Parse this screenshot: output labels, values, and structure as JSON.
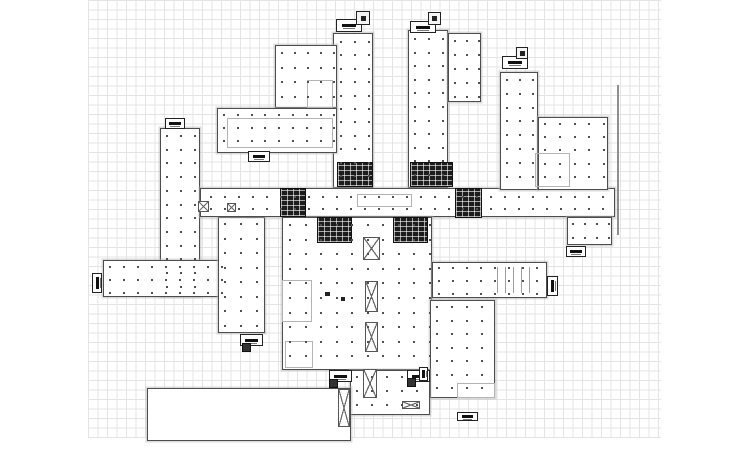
{
  "drawing": {
    "type": "architectural-floor-plan",
    "canvas": {
      "width": 750,
      "height": 450,
      "background": "#ffffff"
    },
    "grid": {
      "x": 88,
      "y": 0,
      "w": 573,
      "h": 438,
      "cell": 9.5,
      "line_color": "#e4e4e4"
    },
    "ref_line": {
      "x": 617,
      "y": 85,
      "h": 150,
      "thickness": 2,
      "color": "#8f8f8f"
    },
    "colors": {
      "outline": "#4d4d4d",
      "inner": "#b3b3b3",
      "core": "#1d1d1d",
      "dot": "#4f4f4f"
    },
    "masses": [
      {
        "name": "wing-north-a",
        "x": 333,
        "y": 33,
        "w": 40,
        "h": 155
      },
      {
        "name": "wing-north-b",
        "x": 408,
        "y": 30,
        "w": 40,
        "h": 158
      },
      {
        "name": "wing-north-b-annex",
        "x": 448,
        "y": 33,
        "w": 33,
        "h": 69
      },
      {
        "name": "block-northwest-upper",
        "x": 275,
        "y": 45,
        "w": 62,
        "h": 63
      },
      {
        "name": "block-northwest-lower",
        "x": 217,
        "y": 108,
        "w": 120,
        "h": 45
      },
      {
        "name": "wing-west-vertical",
        "x": 160,
        "y": 128,
        "w": 40,
        "h": 169
      },
      {
        "name": "wing-west-horizontal",
        "x": 103,
        "y": 260,
        "w": 124,
        "h": 37
      },
      {
        "name": "wing-center-west",
        "x": 218,
        "y": 217,
        "w": 47,
        "h": 116
      },
      {
        "name": "central-corridor",
        "x": 200,
        "y": 188,
        "w": 415,
        "h": 29
      },
      {
        "name": "central-block",
        "x": 282,
        "y": 217,
        "w": 150,
        "h": 153
      },
      {
        "name": "wing-east-horizontal",
        "x": 432,
        "y": 262,
        "w": 115,
        "h": 36
      },
      {
        "name": "wing-northeast-vertical",
        "x": 500,
        "y": 72,
        "w": 38,
        "h": 118
      },
      {
        "name": "wing-northeast-annex",
        "x": 538,
        "y": 117,
        "w": 70,
        "h": 73
      },
      {
        "name": "block-east-mid",
        "x": 567,
        "y": 217,
        "w": 45,
        "h": 28
      },
      {
        "name": "block-southeast",
        "x": 430,
        "y": 300,
        "w": 65,
        "h": 98
      },
      {
        "name": "wing-south-center",
        "x": 350,
        "y": 370,
        "w": 80,
        "h": 45
      },
      {
        "name": "hall-south-west",
        "x": 147,
        "y": 388,
        "w": 204,
        "h": 53
      }
    ],
    "inner_rects": [
      {
        "name": "room-northwest-inner",
        "x": 227,
        "y": 118,
        "w": 106,
        "h": 30
      },
      {
        "name": "room-northwest-corner",
        "x": 307,
        "y": 80,
        "w": 26,
        "h": 28
      },
      {
        "name": "corridor-center-strip",
        "x": 357,
        "y": 194,
        "w": 55,
        "h": 13
      },
      {
        "name": "room-central-west",
        "x": 282,
        "y": 280,
        "w": 30,
        "h": 42
      },
      {
        "name": "room-central-south",
        "x": 285,
        "y": 341,
        "w": 28,
        "h": 27
      },
      {
        "name": "room-northeast-square",
        "x": 535,
        "y": 153,
        "w": 35,
        "h": 34
      },
      {
        "name": "room-southeast-step",
        "x": 457,
        "y": 383,
        "w": 38,
        "h": 15
      }
    ],
    "cores": [
      {
        "name": "core-wing-a",
        "x": 337,
        "y": 162,
        "w": 36,
        "h": 25
      },
      {
        "name": "core-wing-b",
        "x": 410,
        "y": 162,
        "w": 43,
        "h": 25
      },
      {
        "name": "core-corridor-west",
        "x": 280,
        "y": 188,
        "w": 26,
        "h": 29
      },
      {
        "name": "core-corridor-east",
        "x": 455,
        "y": 188,
        "w": 27,
        "h": 30
      },
      {
        "name": "core-central-left",
        "x": 317,
        "y": 217,
        "w": 35,
        "h": 26
      },
      {
        "name": "core-central-right",
        "x": 393,
        "y": 217,
        "w": 35,
        "h": 26
      }
    ],
    "crossed_boxes": [
      {
        "name": "shaft-1",
        "x": 363,
        "y": 237,
        "w": 17,
        "h": 23
      },
      {
        "name": "shaft-2",
        "x": 365,
        "y": 281,
        "w": 13,
        "h": 31
      },
      {
        "name": "shaft-3",
        "x": 365,
        "y": 322,
        "w": 13,
        "h": 30
      },
      {
        "name": "shaft-4",
        "x": 363,
        "y": 369,
        "w": 14,
        "h": 29
      },
      {
        "name": "shaft-5",
        "x": 338,
        "y": 389,
        "w": 12,
        "h": 38
      },
      {
        "name": "shaft-west-1",
        "x": 198,
        "y": 201,
        "w": 11,
        "h": 11
      },
      {
        "name": "shaft-west-2",
        "x": 227,
        "y": 203,
        "w": 9,
        "h": 9
      },
      {
        "name": "vent-bowtie",
        "x": 402,
        "y": 401,
        "w": 18,
        "h": 8
      }
    ],
    "tags": [
      {
        "name": "stair-tag-wing-a",
        "x": 336,
        "y": 19,
        "w": 26,
        "h": 13,
        "dir": "h"
      },
      {
        "name": "stair-tag-wing-b",
        "x": 410,
        "y": 21,
        "w": 26,
        "h": 12,
        "dir": "h"
      },
      {
        "name": "stair-tag-northeast",
        "x": 502,
        "y": 56,
        "w": 26,
        "h": 13,
        "dir": "h"
      },
      {
        "name": "stair-tag-northwest",
        "x": 248,
        "y": 151,
        "w": 22,
        "h": 11,
        "dir": "h"
      },
      {
        "name": "stair-tag-west-top",
        "x": 165,
        "y": 118,
        "w": 20,
        "h": 11,
        "dir": "h"
      },
      {
        "name": "stair-tag-center-south",
        "x": 240,
        "y": 334,
        "w": 23,
        "h": 12,
        "dir": "h"
      },
      {
        "name": "stair-tag-south-left",
        "x": 329,
        "y": 370,
        "w": 23,
        "h": 12,
        "dir": "h"
      },
      {
        "name": "stair-tag-south-right",
        "x": 407,
        "y": 370,
        "w": 23,
        "h": 12,
        "dir": "h"
      },
      {
        "name": "stair-tag-east-mid",
        "x": 566,
        "y": 246,
        "w": 20,
        "h": 11,
        "dir": "h"
      },
      {
        "name": "stair-tag-southeast",
        "x": 457,
        "y": 412,
        "w": 21,
        "h": 9,
        "dir": "h"
      },
      {
        "name": "stair-tag-west-end",
        "x": 92,
        "y": 273,
        "w": 10,
        "h": 20,
        "dir": "v"
      },
      {
        "name": "stair-tag-east-end",
        "x": 547,
        "y": 276,
        "w": 11,
        "h": 20,
        "dir": "v"
      },
      {
        "name": "stair-tag-south-edge",
        "x": 419,
        "y": 367,
        "w": 9,
        "h": 14,
        "dir": "v"
      }
    ],
    "tag_topboxes": [
      {
        "name": "roof-box-wing-a",
        "x": 356,
        "y": 11,
        "w": 14,
        "h": 14
      },
      {
        "name": "roof-box-wing-b",
        "x": 428,
        "y": 12,
        "w": 13,
        "h": 13
      },
      {
        "name": "roof-box-northeast",
        "x": 516,
        "y": 47,
        "w": 12,
        "h": 12
      }
    ],
    "tag_squares": [
      {
        "name": "exit-square-center-south",
        "x": 242,
        "y": 343,
        "w": 9,
        "h": 9
      },
      {
        "name": "exit-square-south-left",
        "x": 329,
        "y": 379,
        "w": 9,
        "h": 9
      },
      {
        "name": "exit-square-south-right",
        "x": 407,
        "y": 378,
        "w": 9,
        "h": 9
      }
    ],
    "stall_lines": {
      "x0": 497,
      "y": 267,
      "h": 26,
      "count": 5,
      "dx": 8,
      "thickness": 1
    },
    "micro_marks": [
      {
        "x": 325,
        "y": 292,
        "w": 5,
        "h": 4
      },
      {
        "x": 341,
        "y": 297,
        "w": 4,
        "h": 4
      }
    ],
    "column_grids": [
      {
        "name": "cols-wing-a",
        "x": 340,
        "y": 41,
        "nx": 3,
        "ny": 11,
        "dx": 14,
        "dy": 13.4
      },
      {
        "name": "cols-wing-b",
        "x": 414,
        "y": 38,
        "nx": 3,
        "ny": 11,
        "dx": 14,
        "dy": 13.6
      },
      {
        "name": "cols-wing-b-annex",
        "x": 454,
        "y": 40,
        "nx": 3,
        "ny": 5,
        "dx": 12,
        "dy": 14
      },
      {
        "name": "cols-northwest-upper",
        "x": 281,
        "y": 52,
        "nx": 5,
        "ny": 4,
        "dx": 13,
        "dy": 14.5
      },
      {
        "name": "cols-northwest-lower",
        "x": 223,
        "y": 114,
        "nx": 9,
        "ny": 3,
        "dx": 13.8,
        "dy": 13
      },
      {
        "name": "cols-west-vertical",
        "x": 166,
        "y": 135,
        "nx": 3,
        "ny": 12,
        "dx": 14,
        "dy": 13.7
      },
      {
        "name": "cols-west-horizontal",
        "x": 109,
        "y": 266,
        "nx": 9,
        "ny": 3,
        "dx": 14,
        "dy": 13
      },
      {
        "name": "cols-center-west",
        "x": 224,
        "y": 223,
        "nx": 3,
        "ny": 8,
        "dx": 16,
        "dy": 14.5
      },
      {
        "name": "cols-corridor",
        "x": 210,
        "y": 196,
        "nx": 29,
        "ny": 2,
        "dx": 14,
        "dy": 12
      },
      {
        "name": "cols-central-block",
        "x": 289,
        "y": 224,
        "nx": 10,
        "ny": 10,
        "dx": 15.5,
        "dy": 14.6
      },
      {
        "name": "cols-east-horizontal",
        "x": 438,
        "y": 267,
        "nx": 8,
        "ny": 3,
        "dx": 14,
        "dy": 13
      },
      {
        "name": "cols-northeast-vertical",
        "x": 506,
        "y": 79,
        "nx": 3,
        "ny": 8,
        "dx": 13,
        "dy": 13.8
      },
      {
        "name": "cols-northeast-annex",
        "x": 544,
        "y": 123,
        "nx": 5,
        "ny": 5,
        "dx": 14.8,
        "dy": 13.2
      },
      {
        "name": "cols-east-mid",
        "x": 572,
        "y": 223,
        "nx": 4,
        "ny": 2,
        "dx": 12,
        "dy": 14
      },
      {
        "name": "cols-southeast",
        "x": 436,
        "y": 306,
        "nx": 4,
        "ny": 7,
        "dx": 15,
        "dy": 13.5
      },
      {
        "name": "cols-south-center",
        "x": 356,
        "y": 376,
        "nx": 5,
        "ny": 3,
        "dx": 15,
        "dy": 14
      }
    ]
  }
}
